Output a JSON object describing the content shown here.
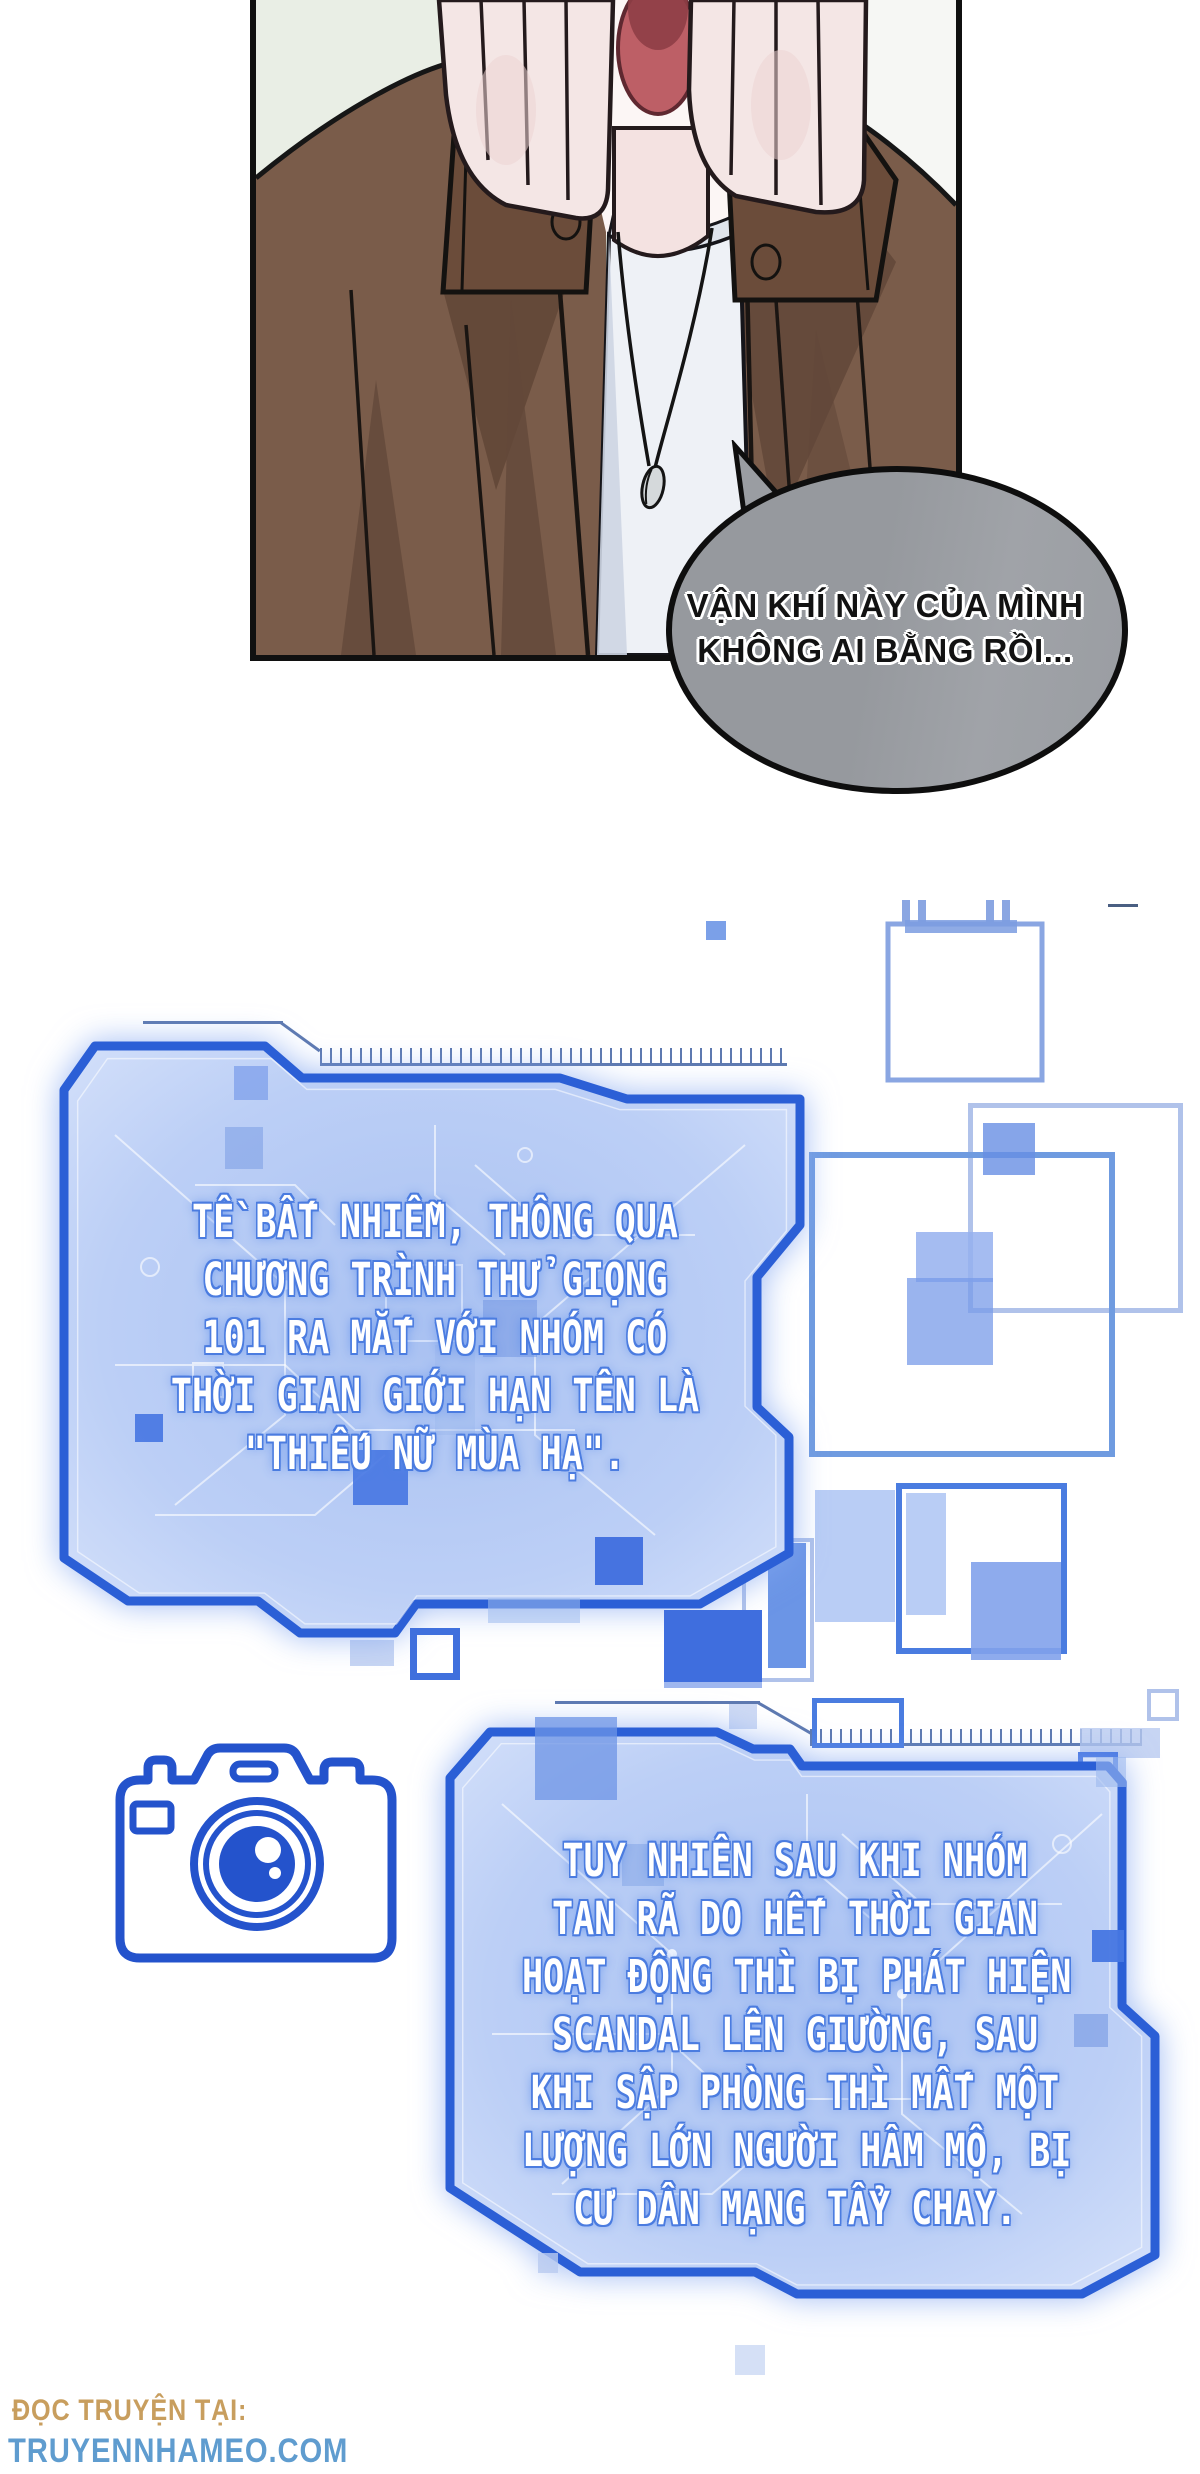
{
  "panel": {
    "bubble": {
      "lines": [
        "VẬN KHÍ NÀY CỦA MÌNH",
        "KHÔNG AI BẰNG RỒI..."
      ]
    }
  },
  "holo1": {
    "lines": [
      "TỀ BẤT NHIỄM, THÔNG QUA",
      "CHƯƠNG TRÌNH THỬ GIỌNG",
      "101 RA MẮT VỚI NHÓM CÓ",
      "THỜI GIAN GIỚI HẠN TÊN LÀ",
      "\"THIẾU NỮ MÙA HẠ\"."
    ]
  },
  "holo2": {
    "lines": [
      "TUY NHIÊN SAU KHI NHÓM",
      "TAN RÃ DO HẾT THỜI GIAN",
      "HOẠT ĐỘNG THÌ BỊ PHÁT HIỆN",
      "SCANDAL LÊN GIƯỜNG, SAU",
      "KHI SẬP PHÒNG THÌ MẤT MỘT",
      "LƯỢNG LỚN NGƯỜI HÂM MỘ, BỊ",
      "CƯ DÂN MẠNG TẨY CHAY."
    ]
  },
  "footer": {
    "reading_label": "ĐỌC TRUYỆN TẠI:",
    "site": "TRUYENNHAMEO.COM"
  },
  "icons": [
    "camera-icon"
  ],
  "colors": {
    "holo_border": "#2b5fd6",
    "holo_fill": "#b6cbf5",
    "bubble_fill": "#9a9da2",
    "footer_label": "#c89e5e",
    "footer_site": "#5f9ccf",
    "camera_blue": "#2453cc"
  }
}
